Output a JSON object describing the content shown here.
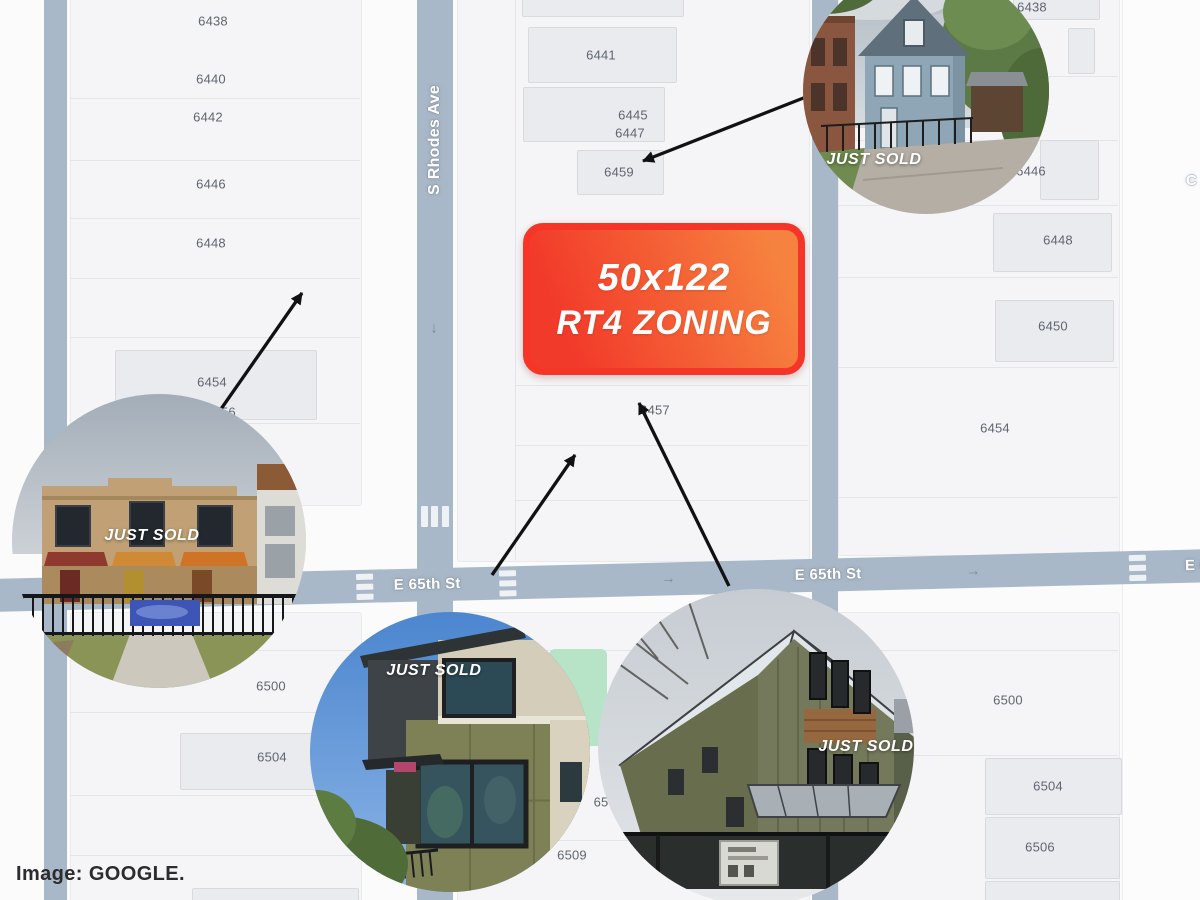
{
  "attribution": "Image: GOOGLE.",
  "badge": {
    "line1": "50x122",
    "line2": "RT4 ZONING"
  },
  "roads": {
    "rhodes": "S Rhodes Ave",
    "e65_west": "E 65th St",
    "e65_mid": "E 65th St",
    "e65_east": "E 65th St",
    "cross_street_fragment": "C",
    "down_arrow": "↓",
    "right_arrow": "→"
  },
  "parcels": {
    "left_top": [
      "6438",
      "6440",
      "6442",
      "6446",
      "6448",
      "6454",
      "6456"
    ],
    "mid_top": [
      "6441",
      "6445",
      "6447",
      "6459",
      "6457"
    ],
    "right_top": [
      "6438",
      "6446",
      "6448",
      "6450",
      "6454"
    ],
    "left_bottom": [
      "6500",
      "6504"
    ],
    "mid_bottom": [
      "65",
      "6509"
    ],
    "right_bottom": [
      "6500",
      "6504",
      "6506"
    ]
  },
  "photos": {
    "top_right": {
      "label": "JUST SOLD",
      "subject": "blue two-flat house"
    },
    "bottom_left": {
      "label": "JUST SOLD",
      "subject": "brick townhomes with awnings"
    },
    "bottom_mid": {
      "label": "JUST SOLD",
      "subject": "modern olive panel home"
    },
    "bottom_right": {
      "label": "JUST SOLD",
      "subject": "olive farmhouse new construction"
    }
  },
  "colors": {
    "road": "#a9b8c8",
    "badge_border": "#f43527",
    "badge_gradient_start": "#f23a2a",
    "badge_gradient_end": "#f6823f",
    "arrow": "#111111",
    "park": "#b7e3c6"
  }
}
